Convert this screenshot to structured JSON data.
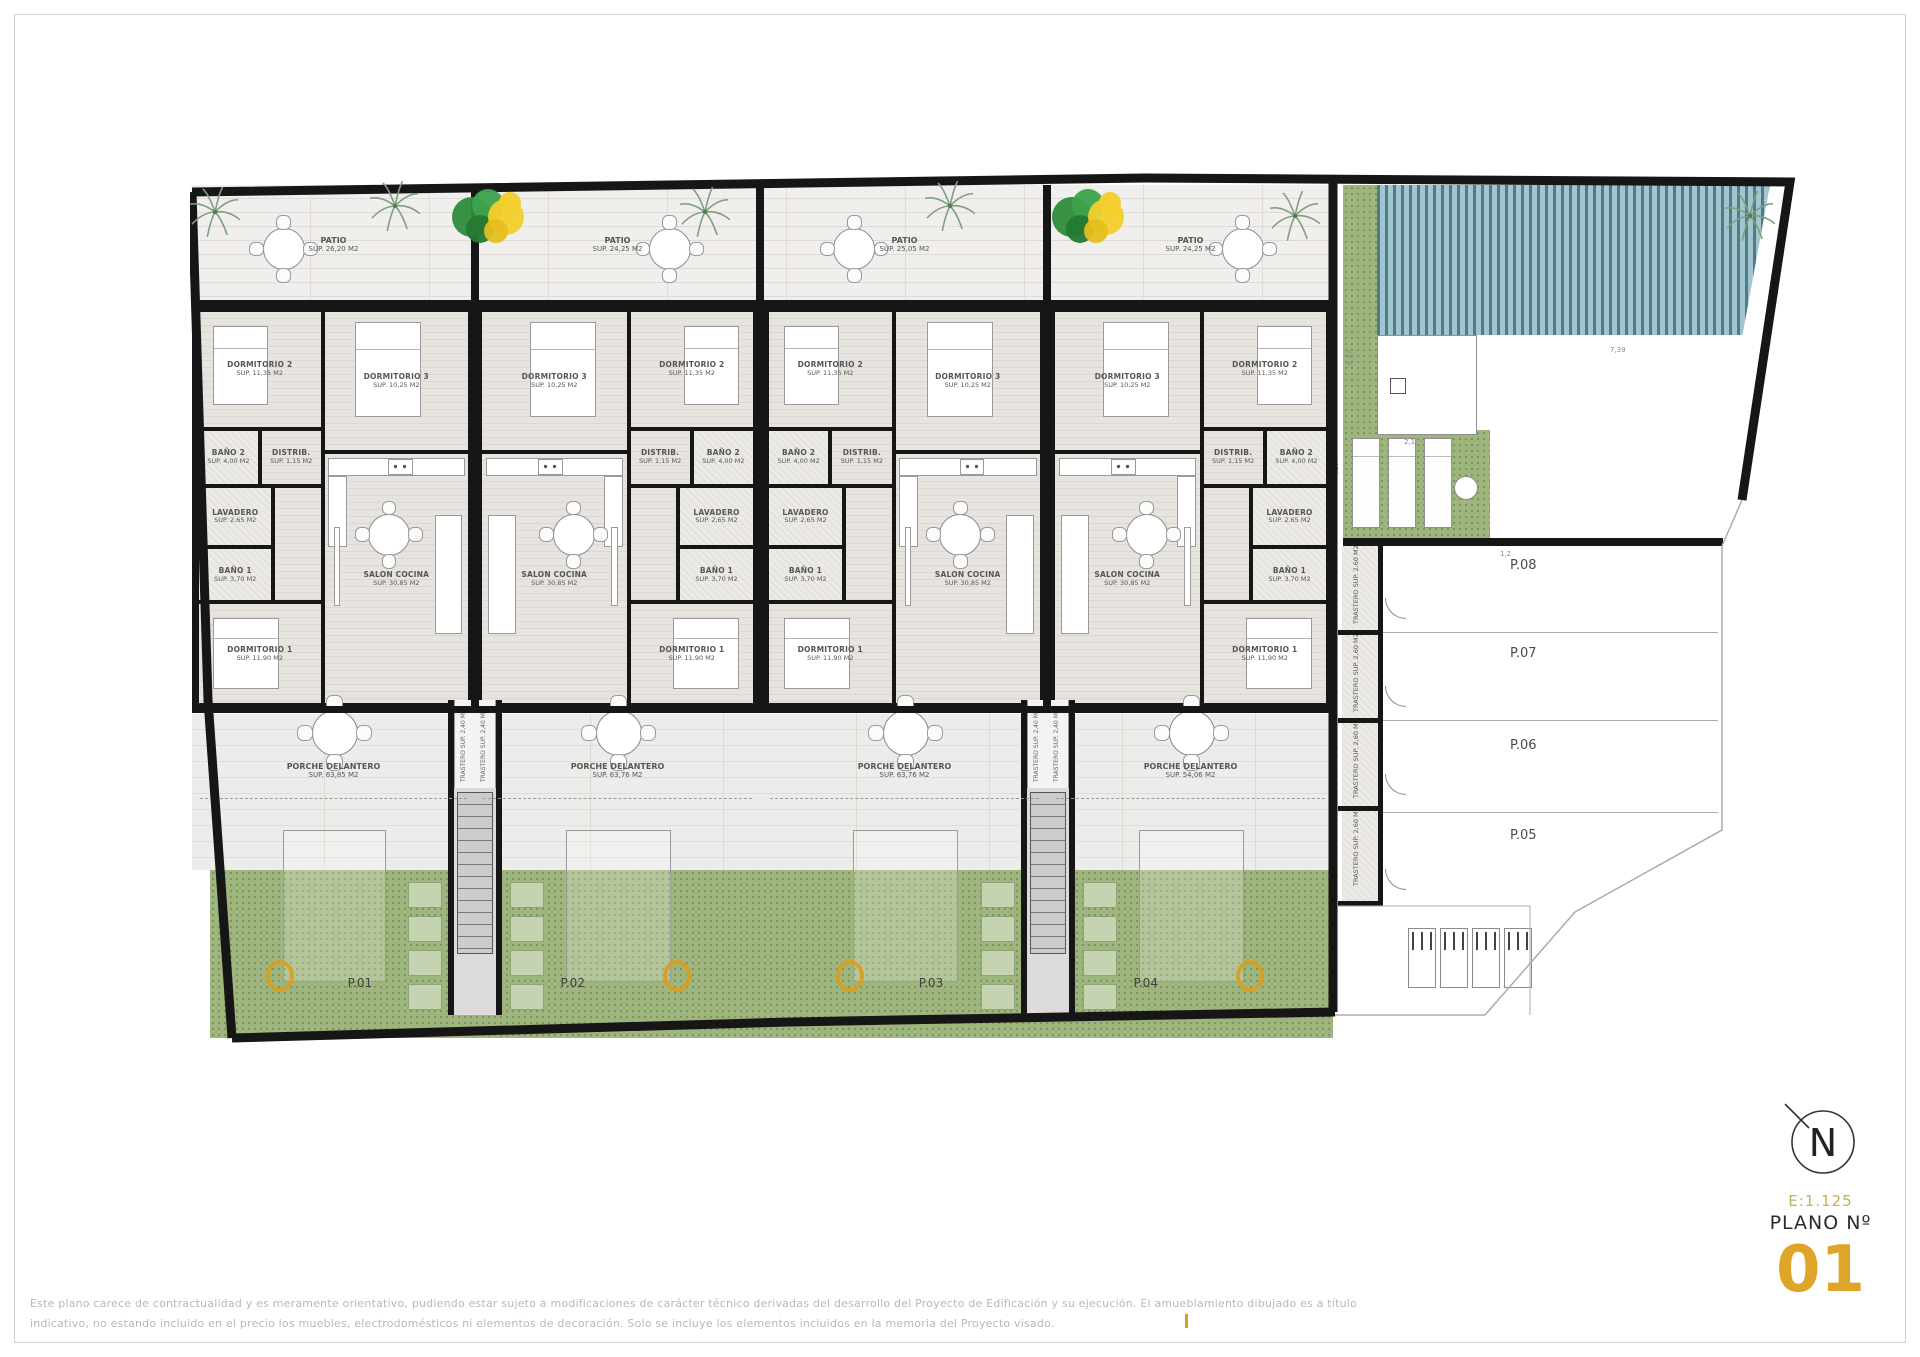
{
  "title_block": {
    "north": "N",
    "scale": "E:1.125",
    "plano_label": "PLANO Nº",
    "number": "01"
  },
  "disclaimer": {
    "line1": "Este plano carece de contractualidad y es meramente orientativo, pudiendo estar sujeto a modificaciones de carácter técnico derivadas del desarrollo del Proyecto de Edificación y su ejecución. El amueblamiento dibujado es a título",
    "line2": "indicativo, no estando incluido en el precio los muebles, electrodomésticos ni elementos de decoración. Solo se incluye los elementos incluidos en la memoria del Proyecto visado."
  },
  "plots": [
    {
      "id": "P.01",
      "x": 2,
      "w": 283,
      "mirrored": false
    },
    {
      "id": "P.02",
      "x": 285,
      "w": 285,
      "mirrored": true
    },
    {
      "id": "P.03",
      "x": 572,
      "w": 285,
      "mirrored": false
    },
    {
      "id": "P.04",
      "x": 858,
      "w": 285,
      "mirrored": true
    }
  ],
  "patios": [
    {
      "label": "PATIO",
      "area": "SUP. 26,20 M2"
    },
    {
      "label": "PATIO",
      "area": "SUP. 24,25 M2"
    },
    {
      "label": "PATIO",
      "area": "SUP. 25,05 M2"
    },
    {
      "label": "PATIO",
      "area": "SUP. 24,25 M2"
    }
  ],
  "porches": [
    {
      "label": "PORCHE DELANTERO",
      "area": "SUP. 63,85 M2"
    },
    {
      "label": "PORCHE DELANTERO",
      "area": "SUP. 63,76 M2"
    },
    {
      "label": "PORCHE DELANTERO",
      "area": "SUP. 63,76 M2"
    },
    {
      "label": "PORCHE DELANTERO",
      "area": "SUP. 54,06 M2"
    }
  ],
  "unit_rooms": [
    {
      "key": "dormitorio-2",
      "label": "DORMITORIO 2",
      "area": "SUP. 11,35 M2",
      "x": 0,
      "y": 0,
      "w": 0.46,
      "h": 0.3,
      "wet": false
    },
    {
      "key": "dormitorio-3",
      "label": "DORMITORIO 3",
      "area": "SUP. 10,25 M2",
      "x": 0.46,
      "y": 0,
      "w": 0.54,
      "h": 0.36,
      "wet": false
    },
    {
      "key": "bano-2",
      "label": "BAÑO 2",
      "area": "SUP. 4,00 M2",
      "x": 0,
      "y": 0.3,
      "w": 0.23,
      "h": 0.145,
      "wet": true
    },
    {
      "key": "distribuidor",
      "label": "DISTRIB.",
      "area": "SUP. 1,15 M2",
      "x": 0.23,
      "y": 0.3,
      "w": 0.23,
      "h": 0.145,
      "wet": false
    },
    {
      "key": "lavadero",
      "label": "LAVADERO",
      "area": "SUP. 2,65 M2",
      "x": 0,
      "y": 0.445,
      "w": 0.28,
      "h": 0.155,
      "wet": true
    },
    {
      "key": "bano-1",
      "label": "BAÑO 1",
      "area": "SUP. 3,70 M2",
      "x": 0,
      "y": 0.6,
      "w": 0.28,
      "h": 0.14,
      "wet": true
    },
    {
      "key": "dormitorio-1",
      "label": "DORMITORIO 1",
      "area": "SUP. 11,90 M2",
      "x": 0,
      "y": 0.74,
      "w": 0.46,
      "h": 0.26,
      "wet": false
    },
    {
      "key": "pasillo",
      "label": "",
      "area": "",
      "x": 0.28,
      "y": 0.445,
      "w": 0.18,
      "h": 0.295,
      "wet": false
    },
    {
      "key": "salon-cocina",
      "label": "SALON COCINA",
      "area": "SUP. 30,85 M2",
      "x": 0.46,
      "y": 0.36,
      "w": 0.54,
      "h": 0.64,
      "wet": false
    }
  ],
  "furniture": [
    {
      "cls": "bed",
      "x": 0.06,
      "y": 0.04,
      "w": 0.2,
      "h": 0.2
    },
    {
      "cls": "bed",
      "x": 0.58,
      "y": 0.03,
      "w": 0.24,
      "h": 0.24
    },
    {
      "cls": "bed",
      "x": 0.06,
      "y": 0.78,
      "w": 0.24,
      "h": 0.18
    },
    {
      "cls": "counter",
      "x": 0.48,
      "y": 0.375,
      "w": 0.5,
      "h": 0.045
    },
    {
      "cls": "counter",
      "x": 0.48,
      "y": 0.42,
      "w": 0.07,
      "h": 0.18
    },
    {
      "cls": "hob",
      "x": 0.7,
      "y": 0.378,
      "w": 0.09,
      "h": 0.04
    },
    {
      "cls": "sofa",
      "x": 0.87,
      "y": 0.52,
      "w": 0.1,
      "h": 0.3
    },
    {
      "cls": "shelf",
      "x": 0.5,
      "y": 0.55,
      "w": 0.025,
      "h": 0.2
    },
    {
      "t": "table",
      "x": 0.6,
      "y": 0.5,
      "w": 0.15,
      "h": 0.105
    }
  ],
  "stair_trastero": {
    "text": "TRASTERO SUP. 2,40 M2"
  },
  "storage": {
    "text": "TRASTERO SUP. 2,60 M2"
  },
  "parking": [
    "P.08",
    "P.07",
    "P.06",
    "P.05"
  ],
  "dimensions": [
    "9,47",
    "2,1",
    "4,10",
    "1,2",
    "7,39"
  ],
  "colors": {
    "wall": "#161616",
    "grass": "#9fb57e",
    "pool_dark": "#4d7c8c",
    "pool_light": "#a3c6cd",
    "accent_gold": "#dfa529",
    "scale_gold": "#c5ad5e",
    "label_gray": "#565656",
    "disclaimer_gray": "#b8b8b8"
  }
}
